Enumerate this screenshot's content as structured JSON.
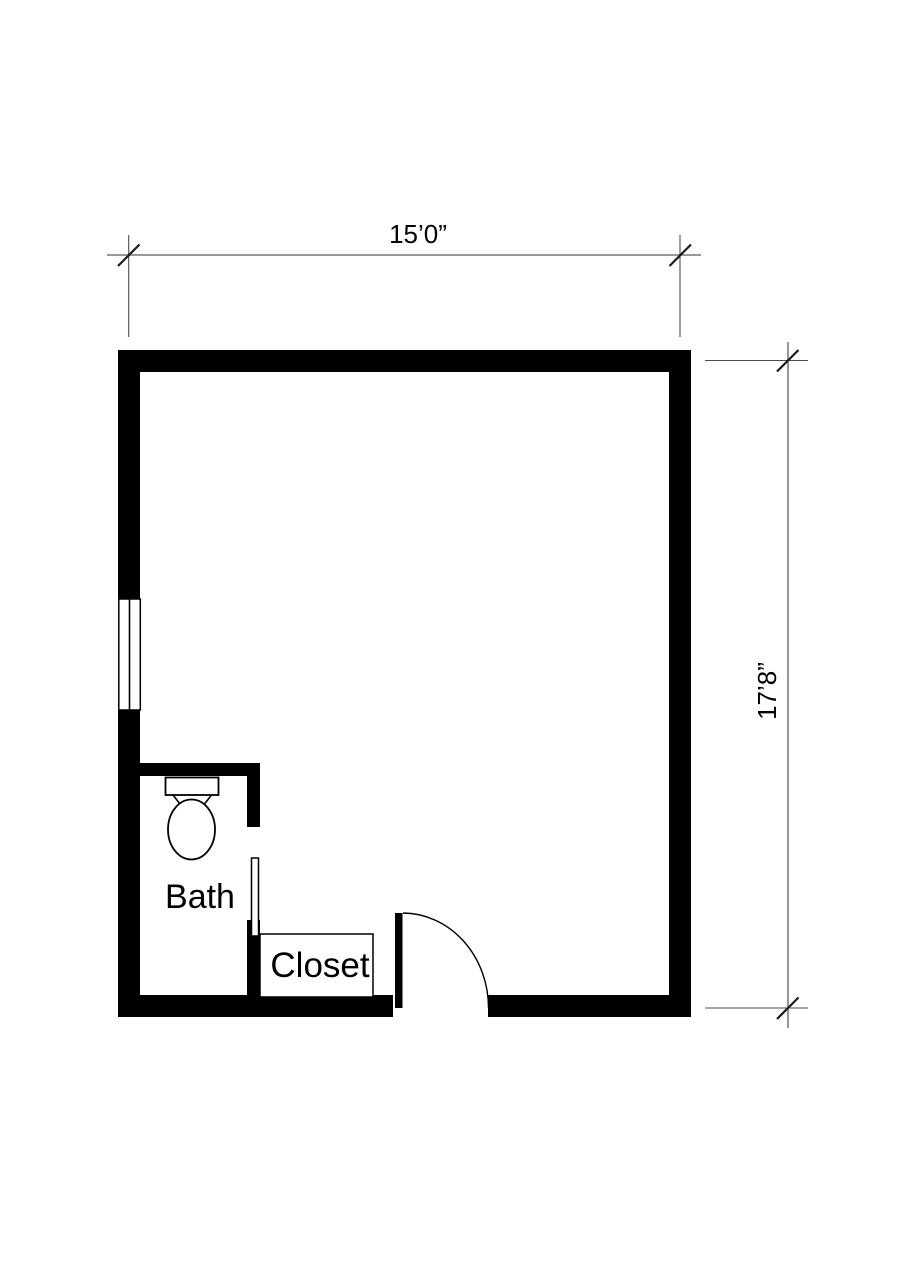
{
  "document": {
    "type": "architectural-floor-plan",
    "background_color": "#ffffff"
  },
  "colors": {
    "wall_fill": "#000000",
    "fixture_stroke": "#000000",
    "dimension_line": "#8a8a8a",
    "extension_line": "#4d4d4d",
    "tick_mark": "#1a1a1a",
    "label_text": "#000000"
  },
  "dimensions": {
    "top": {
      "label": "15’0”",
      "orientation": "horizontal"
    },
    "right": {
      "label": "17’8”",
      "orientation": "vertical-rotated"
    }
  },
  "rooms": {
    "bath": {
      "label": "Bath"
    },
    "closet": {
      "label": "Closet"
    }
  },
  "fixtures": {
    "toilet": "toilet-plan-symbol",
    "window": "window-with-center-mullion",
    "entry_door": "door-leaf-with-quarter-swing-arc",
    "bath_door": "open-door-leaf"
  }
}
